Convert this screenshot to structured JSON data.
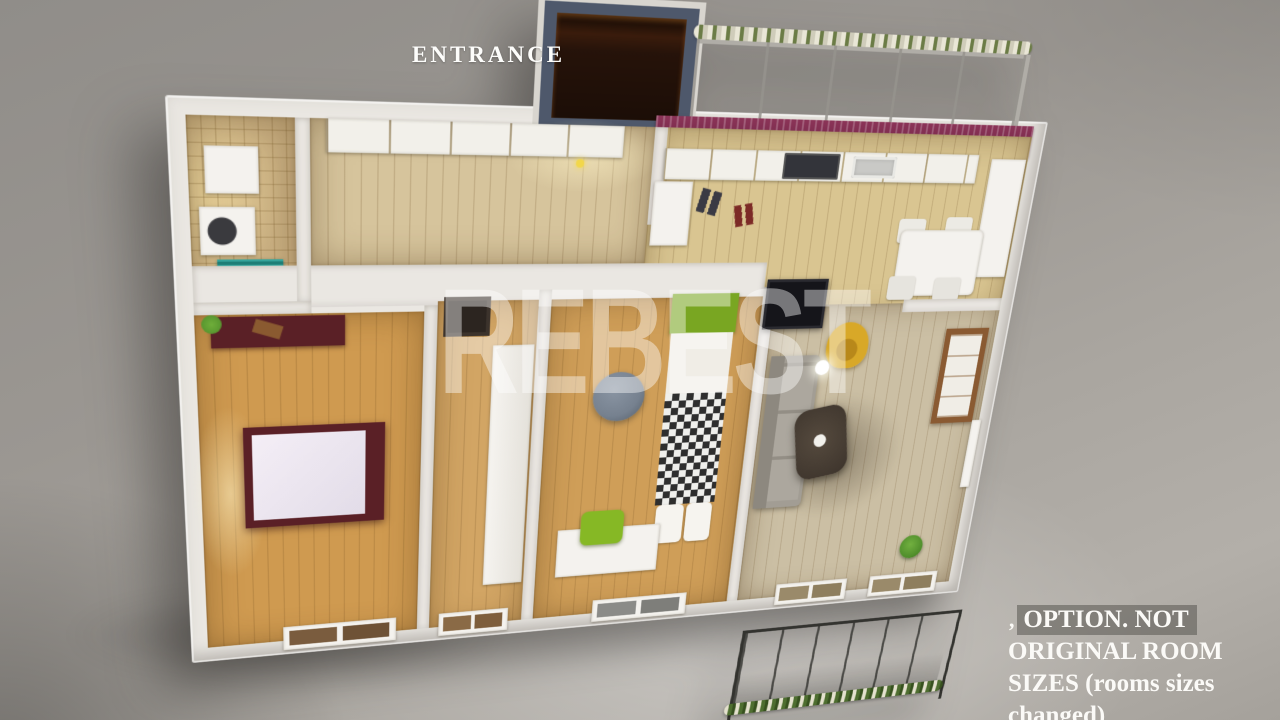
{
  "overlay": {
    "entrance_label": "ENTRANCE",
    "watermark": "REBEST",
    "note": {
      "prefix": "‚",
      "line1": "OPTION. NOT",
      "line2": "ORIGINAL ROOM",
      "line3": "SIZES (rooms sizes",
      "line4": "changed)"
    }
  },
  "colors": {
    "wall": "#eae7e2",
    "wall_shade": "#d3d0ca",
    "kitchen_accent_wall": "#7b2d4f",
    "bath_tile": "#cbb183",
    "hall_wood": "#d6c49c",
    "kitchen_wood": "#d9c591",
    "kid_wood": "#cf9e58",
    "narrow_wood": "#d2a564",
    "bedroom_wood": "#cf9a50",
    "living_floor": "#cbbfa4",
    "teal_shelf": "#35a49b",
    "maroon_furniture": "#5a2026",
    "green_bed": "#79a622",
    "green_chair": "#86b825",
    "yellow_chair": "#d8a828",
    "sofa_gray": "#a29d94",
    "coffee_table": "#3c332b",
    "tv_black": "#15151a",
    "rail_dark": "#33332f",
    "rail_light": "#b0ada7",
    "vestibule_frame": "#4e586b",
    "vestibule_dark": "#20100a",
    "pouf_gray": "#76818f",
    "plant_green": "#4e8c2a"
  }
}
